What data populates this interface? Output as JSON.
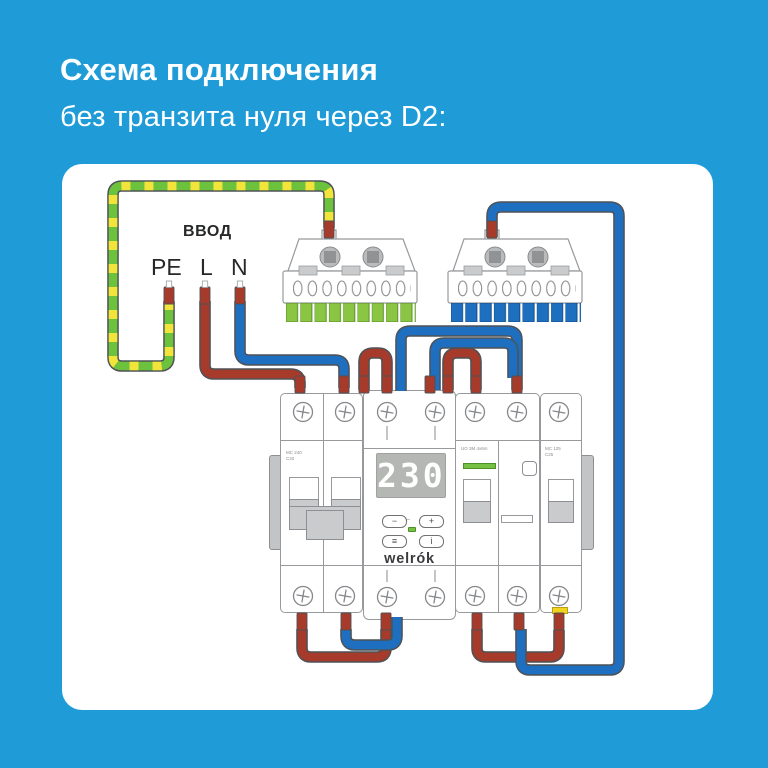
{
  "title": {
    "line1": "Схема подключения",
    "line2": "без транзита нуля через D2:"
  },
  "input_labels": {
    "header": "ВВОД",
    "pe": "PE",
    "l": "L",
    "n": "N"
  },
  "relay": {
    "brand": "welrók",
    "display_value": "230",
    "buttons": {
      "minus": "−",
      "plus": "+",
      "menu": "≡",
      "info": "i"
    }
  },
  "micro_labels": {
    "breaker1": "MC 240\nC40",
    "breaker2": "UO 3M 4x6m",
    "breaker3": "MC 125\nC25"
  },
  "wires": [
    {
      "name": "pe-ground-wire",
      "colors": [
        "green",
        "yellow"
      ]
    },
    {
      "name": "line-wire",
      "colors": [
        "red"
      ]
    },
    {
      "name": "neutral-wire",
      "colors": [
        "blue"
      ]
    }
  ],
  "buses": [
    {
      "name": "pe-bus-terminal-block",
      "teeth_color": "green"
    },
    {
      "name": "n-bus-terminal-block",
      "teeth_color": "blue"
    }
  ],
  "colors": {
    "bg_blue": "#1f9cd8",
    "panel_white": "#ffffff",
    "text_dark": "#272829",
    "wire_red": "#a63a2b",
    "wire_blue": "#1e6fc0",
    "wire_green": "#6cc13d",
    "wire_yellow": "#f2e43a",
    "teeth_green": "#8ac543",
    "led_green": "#76c043",
    "display_gray": "#b4b7b4",
    "yellow_marker": "#f0d41f"
  }
}
